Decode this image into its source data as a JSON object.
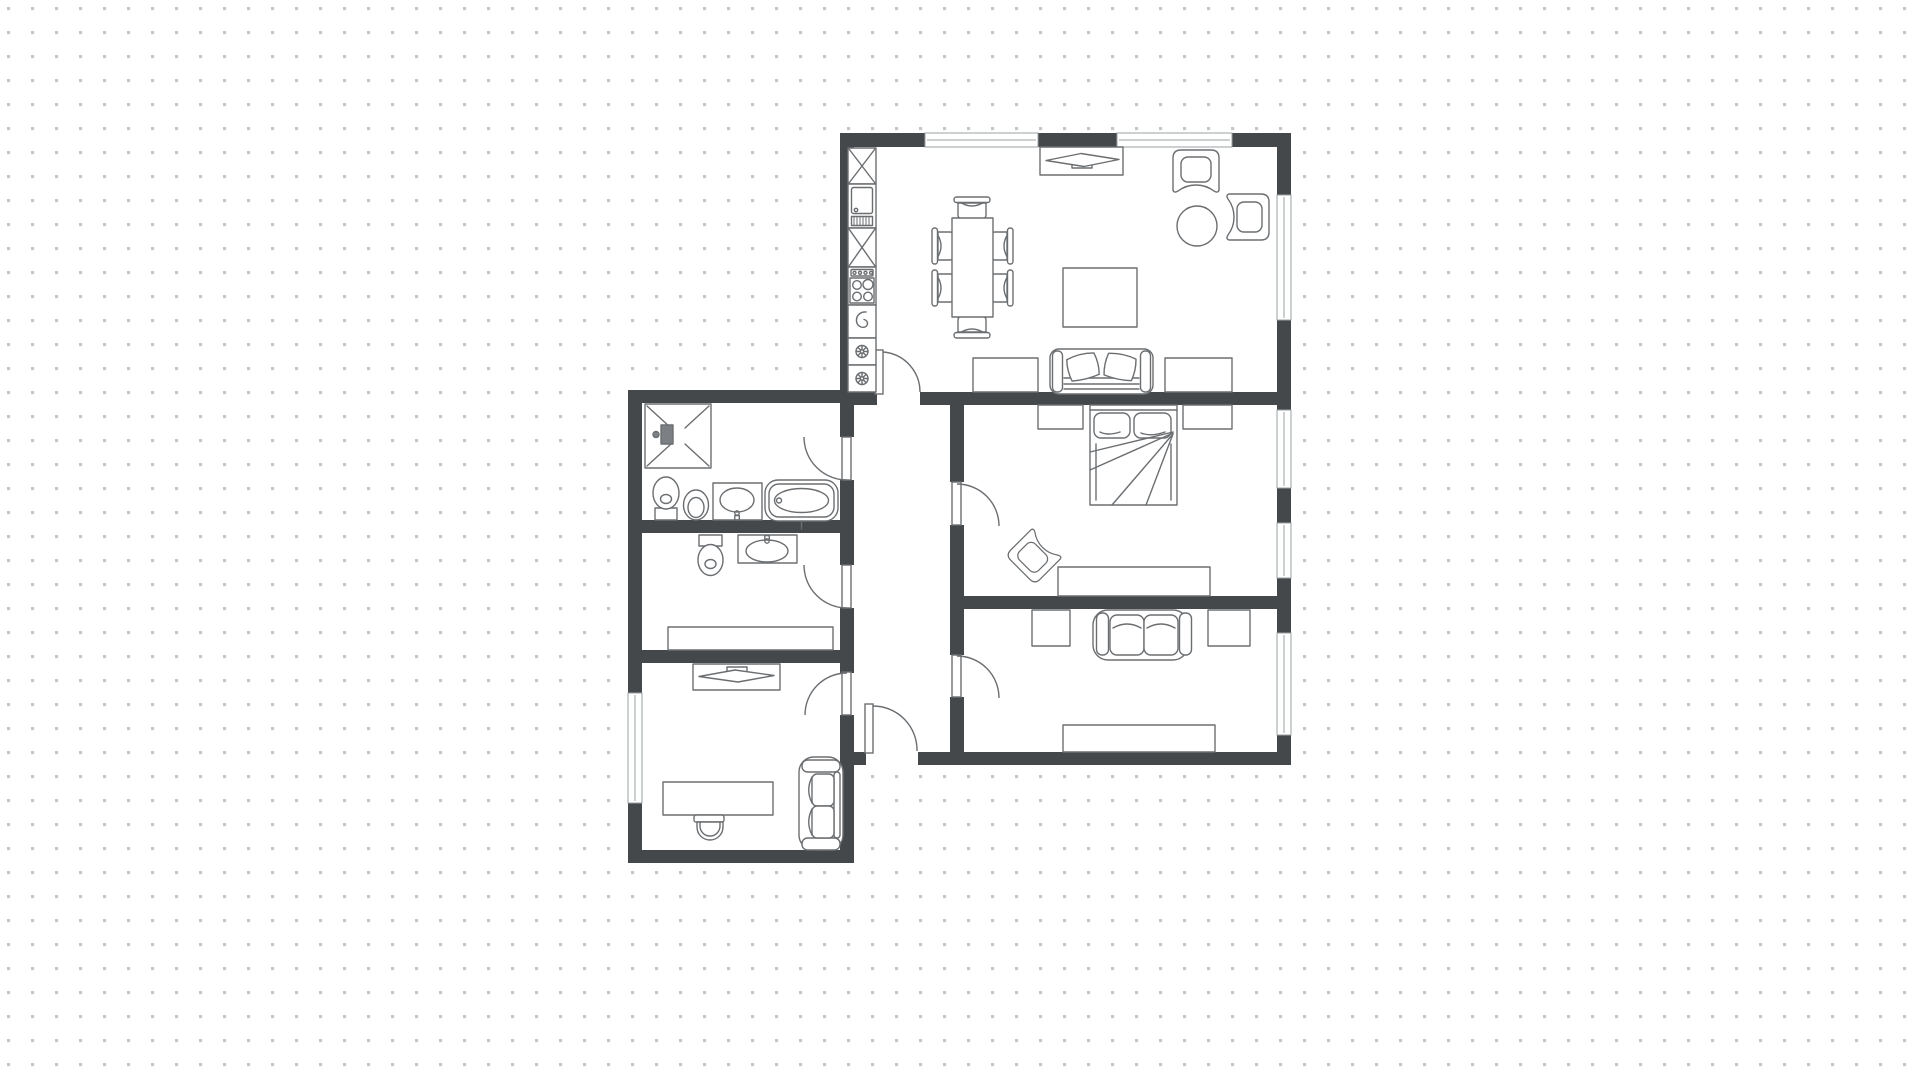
{
  "canvas": {
    "width": 1920,
    "height": 1078,
    "background": "#ffffff",
    "dot_grid": {
      "color": "#c7c7c7",
      "spacing_px": 24,
      "dot_size_px": 3
    }
  },
  "palette": {
    "wall": "#45484b",
    "floor": "#ffffff",
    "furniture_stroke": "#6b6e71",
    "window_frame": "#9aa0a3",
    "fixture_fill": "#7c8084"
  },
  "floor_plan": {
    "type": "apartment-floor-plan",
    "rooms": [
      {
        "id": "living-kitchen",
        "furniture": [
          "kitchen-cabinet-x2",
          "refrigerator",
          "stove-4-burner",
          "kitchen-sink-unit",
          "appliance-unit-x2",
          "dining-table",
          "dining-chair-x6",
          "tv-media-console",
          "tv",
          "armchair-x2",
          "round-side-table",
          "coffee-table",
          "sofa-with-2-pillows",
          "side-table-x2"
        ],
        "windows": 3,
        "doors": 1
      },
      {
        "id": "bedroom",
        "furniture": [
          "double-bed-with-2-pillows",
          "nightstand-x2",
          "armchair-angled",
          "dresser"
        ],
        "windows": 2,
        "doors": 1
      },
      {
        "id": "lounge-room",
        "furniture": [
          "loveseat-sofa",
          "side-table-x2",
          "sideboard"
        ],
        "windows": 1,
        "doors": 1
      },
      {
        "id": "bathroom",
        "furniture": [
          "shower-enclosure",
          "toilet",
          "bidet",
          "vanity-sink",
          "bathtub"
        ],
        "windows": 0,
        "doors": 1
      },
      {
        "id": "wc",
        "furniture": [
          "toilet",
          "vanity-sink",
          "cabinet"
        ],
        "windows": 0,
        "doors": 1
      },
      {
        "id": "office",
        "furniture": [
          "tv-media-console",
          "tv",
          "desk",
          "desk-chair",
          "loveseat-sofa"
        ],
        "windows": 1,
        "doors": 1
      },
      {
        "id": "hallway",
        "furniture": [],
        "windows": 0,
        "doors": 7
      }
    ]
  }
}
